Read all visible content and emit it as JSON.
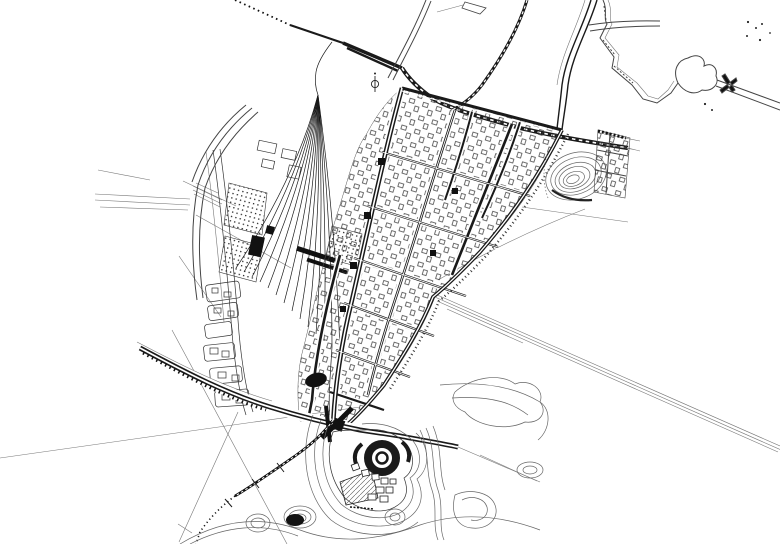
{
  "app": {
    "type": "cad-site-plan-viewport",
    "description": "Monochrome CAD/urban master-plan line drawing: railway station with fanned track yard, rotated street grid of city blocks, river with pond to the northeast, contoured hill, lake park with circular landmark island to the south, and long straight survey/construction lines crossing the sheet",
    "background": "#ffffff"
  },
  "colors": {
    "ink": "#1a1a1a",
    "mid": "#444444",
    "thin": "#777777",
    "contour": "#666666",
    "building": "#333333",
    "fill_dark": "#111111",
    "paper": "#ffffff"
  },
  "features": {
    "railway_mainline": "dotted-to-solid railway entering from north-west, running east through station throat past the hill",
    "railway_branch_north": "tie-hatched branch line from the north edge merging at the station east throat",
    "railway_yard": "fan of sidings spreading south from the station throat with staggered track tips",
    "station_aprons": "dot-grid hatched aprons/platforms beside the yard",
    "street_grid": "rotated grid of double-line streets with small building footprints in each block",
    "main_spine_road": "heavy north-south arterial through the grid",
    "east_arc_road": "curved eastern boundary road of the grid",
    "south_expressway": "wide curved road bundle crossing the south with rail ties and an interchange",
    "south_branch_railway": "curved tie-marked branch turning south-west, fading to a dotted alignment",
    "survey_lines": "long thin straight construction/survey lines crossing the sheet, including a triple-line road alignment to the south-east",
    "river_north": "meandering double-line river with pond and weir symbol, channel exiting east",
    "north_road": "curved double-line road sweeping down from the top edge with a spur to the north-east",
    "hill_contours_ne": "concentric contour rings of a hill east of the grid",
    "lake_park": "southern lake park: nested shoreline contours, circular dark landmark ring, fan-shaped building cluster, small contoured knolls and dark pond",
    "west_lots": "column of rectangular development lots along a curved street west of the yard",
    "benchmark_symbol": "small circle-and-stem survey symbol near the yard throat",
    "ne_lot_grid": "small gridded lot cluster at the far north-east edge of development"
  },
  "canvas": {
    "width": 780,
    "height": 544,
    "aria_label": "CAD site plan drawing"
  }
}
